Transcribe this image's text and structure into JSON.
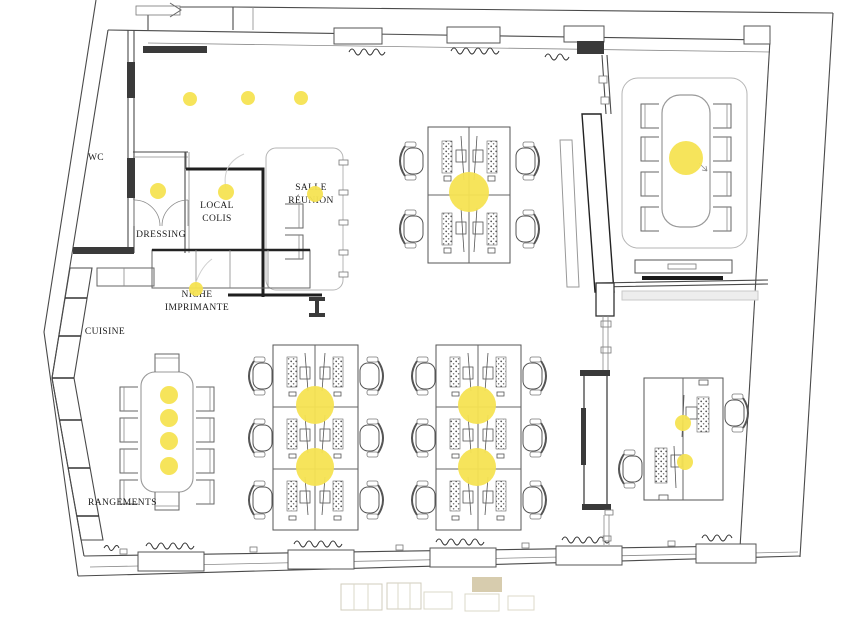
{
  "colors": {
    "background": "#ffffff",
    "wall": "#4a4a4a",
    "wall_dark": "#1f1f1f",
    "furniture_line": "#555555",
    "rug_line": "#b5b5b5",
    "accent_yellow": "#F5E352",
    "stamp_tan": "#c4b488"
  },
  "rooms": {
    "wc": {
      "label": "WC"
    },
    "dressing": {
      "label": "DRESSING"
    },
    "local_colis": {
      "line1": "LOCAL",
      "line2": "COLIS"
    },
    "salle_reunion": {
      "line1": "SALLE",
      "line2": "RÉUNION"
    },
    "niche_imprimante": {
      "line1": "NICHE",
      "line2": "IMPRIMANTE"
    },
    "cuisine": {
      "label": "CUISINE"
    },
    "rangements": {
      "label": "RANGEMENTS"
    }
  },
  "lights": {
    "color": "#F5E352",
    "positions": [
      [
        190,
        99,
        7
      ],
      [
        248,
        98,
        7
      ],
      [
        301,
        98,
        7
      ],
      [
        158,
        191,
        8
      ],
      [
        226,
        192,
        8
      ],
      [
        315,
        194,
        8
      ],
      [
        196,
        289,
        7
      ],
      [
        169,
        395,
        9
      ],
      [
        169,
        418,
        9
      ],
      [
        169,
        441,
        9
      ],
      [
        169,
        466,
        9
      ],
      [
        683,
        423,
        8
      ],
      [
        685,
        462,
        8
      ],
      [
        469,
        192,
        20
      ],
      [
        686,
        158,
        17
      ],
      [
        315,
        405,
        19
      ],
      [
        315,
        467,
        19
      ],
      [
        477,
        405,
        19
      ],
      [
        477,
        467,
        19
      ]
    ]
  },
  "furniture": {
    "workstation_cluster_top": {
      "desks": 4,
      "chairs": 4
    },
    "workstation_cluster_bottom_left": {
      "desks": 6,
      "chairs": 6
    },
    "workstation_cluster_bottom_right": {
      "desks": 6,
      "chairs": 6
    },
    "duo_desk_right": {
      "desks": 2,
      "chairs": 2
    },
    "meeting_table_seats": 8,
    "kitchen_table_seats": 10,
    "lounge_armchairs": 2,
    "storage_segments": 6
  }
}
